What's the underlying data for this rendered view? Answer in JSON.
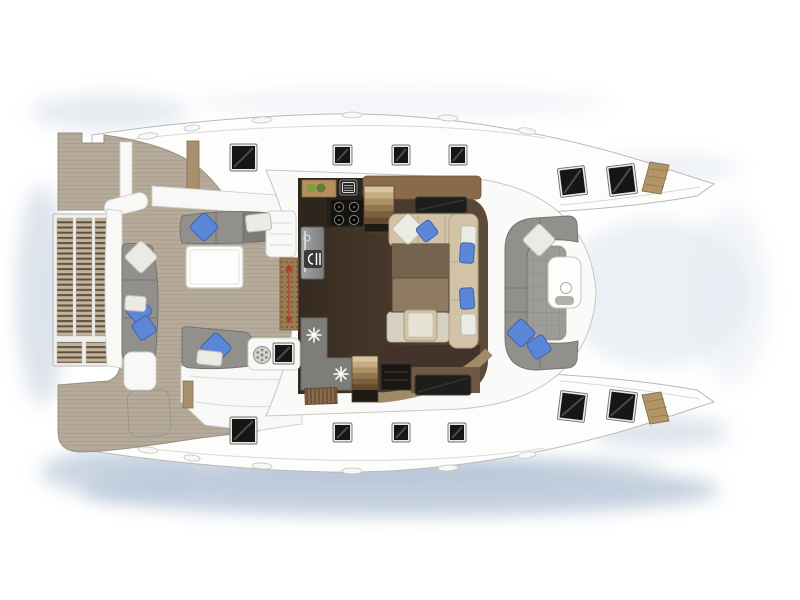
{
  "meta": {
    "title": "Catamaran yacht deck and saloon floor plan, top view",
    "type": "boat-floor-plan",
    "canvas": {
      "width": 800,
      "height": 600
    },
    "text_visible": "none"
  },
  "palette": {
    "bg": "#ffffff",
    "hull_white": "#fdfdfc",
    "hull_outline": "#b9b9b6",
    "deck_seam": "#d8d8d5",
    "cabin_white": "#fafaf8",
    "cabin_outline": "#c6c6c3",
    "teak": "#b6ab9a",
    "teak_line": "#8f8170",
    "teak_outline": "#97907f",
    "slat_tan": "#c3b39a",
    "slat_dark": "#5d5040",
    "platform_frame": "#f0efec",
    "platform_outline": "#b8b8b5",
    "post_tan": "#a9906c",
    "post_outline": "#86704f",
    "salon_floor_dark": "#352a20",
    "salon_floor_mid": "#5d4a38",
    "counter_dark": "#2e261d",
    "stove_black": "#141310",
    "burner_ring": "#75756f",
    "fridge_light": "#a3a4a6",
    "fridge_dark": "#7d7e80",
    "fridge_outline": "#5f5f5f",
    "counter_gray": "#7d7d79",
    "counter_gray_line": "#6a6a66",
    "wood_cabinet": "#8a6b49",
    "wood_dark": "#43332a",
    "wood_mid": "#6f5942",
    "wood_trim": "#a08a68",
    "stair_void": "#1f1a14",
    "bench_beige": "#d2c2a6",
    "bench_beige_line": "#b3a184",
    "bench_pale": "#d6d0c2",
    "table_wood_top": "#74634e",
    "table_wood_bottom": "#8f7b62",
    "table_wood_outline": "#4f4335",
    "ottoman_top": "#e7e2d6",
    "sofa_gray": "#91908c",
    "sofa_gray_dark": "#7e7c78",
    "sofa_line": "#75736f",
    "pillow_blue": "#5c86d8",
    "pillow_blue_edge": "#3e63a8",
    "pillow_white": "#ecebe3",
    "pillow_white_edge": "#bfbcb0",
    "hatch_frame": "#ececea",
    "hatch_frame_edge": "#6f6f6c",
    "hatch_glass": "#161614",
    "hatch_streak": "#8a8a86",
    "skylight": "#1d1d1b",
    "skylight_edge": "#3c3c38",
    "bow_step_tan": "#b29569",
    "bow_step_line": "#8a7048",
    "mat_brown": "#9b7b51",
    "mat_dot": "#6a4f30",
    "mat_outline": "#7c5f3c",
    "arrow_red": "#b5392e",
    "tile_gray": "#9c9c99",
    "tile_line": "#8b8b88",
    "white_furniture": "#f8f8f6",
    "white_furniture_outline": "#cfcfcc",
    "table_white": "#fdfdfc",
    "table_white_outline": "#c6c6c3",
    "green_decor": "#7da03f",
    "green_decor_dark": "#5e7f2c",
    "board_tan": "#b5905e",
    "board_outline": "#8a6b42",
    "shadow_blue": "#b4c3d6"
  },
  "elements": {
    "shadows": [
      {
        "cx": 400,
        "cy": 490,
        "rx": 320,
        "ry": 26,
        "color": "#b4c3d6",
        "opacity": 0.8
      },
      {
        "cx": 360,
        "cy": 468,
        "rx": 300,
        "ry": 11,
        "color": "#9db0c8",
        "opacity": 0.5
      },
      {
        "cx": 120,
        "cy": 472,
        "rx": 80,
        "ry": 22,
        "color": "#bcc9da",
        "opacity": 0.7
      },
      {
        "cx": 660,
        "cy": 432,
        "rx": 70,
        "ry": 16,
        "color": "#c8d3e1",
        "opacity": 0.6
      },
      {
        "cx": 42,
        "cy": 295,
        "rx": 26,
        "ry": 110,
        "color": "#c8d2e0",
        "opacity": 0.6
      },
      {
        "cx": 110,
        "cy": 112,
        "rx": 80,
        "ry": 18,
        "color": "#d6dee8",
        "opacity": 0.6
      },
      {
        "cx": 400,
        "cy": 103,
        "rx": 210,
        "ry": 14,
        "color": "#e4e9f0",
        "opacity": 0.5
      },
      {
        "cx": 665,
        "cy": 168,
        "rx": 75,
        "ry": 14,
        "color": "#dbe2ec",
        "opacity": 0.5
      },
      {
        "cx": 655,
        "cy": 293,
        "rx": 95,
        "ry": 75,
        "color": "#dde4ed",
        "opacity": 0.55
      },
      {
        "cx": 730,
        "cy": 295,
        "rx": 40,
        "ry": 90,
        "color": "#e6ebf2",
        "opacity": 0.5
      }
    ],
    "deck_hatches": [
      {
        "x": 232,
        "y": 146,
        "w": 23,
        "h": 23,
        "rot": 0
      },
      {
        "x": 335,
        "y": 147,
        "w": 15,
        "h": 16,
        "rot": 0
      },
      {
        "x": 394,
        "y": 147,
        "w": 14,
        "h": 16,
        "rot": 0
      },
      {
        "x": 451,
        "y": 147,
        "w": 14,
        "h": 16,
        "rot": 0
      },
      {
        "x": 561,
        "y": 169,
        "w": 23,
        "h": 25,
        "rot": -7
      },
      {
        "x": 610,
        "y": 167,
        "w": 24,
        "h": 26,
        "rot": -7
      },
      {
        "x": 232,
        "y": 419,
        "w": 23,
        "h": 23,
        "rot": 0
      },
      {
        "x": 335,
        "y": 425,
        "w": 15,
        "h": 15,
        "rot": 0
      },
      {
        "x": 394,
        "y": 425,
        "w": 14,
        "h": 15,
        "rot": 0
      },
      {
        "x": 450,
        "y": 425,
        "w": 14,
        "h": 15,
        "rot": 0
      },
      {
        "x": 561,
        "y": 394,
        "w": 23,
        "h": 25,
        "rot": 7
      },
      {
        "x": 610,
        "y": 393,
        "w": 24,
        "h": 26,
        "rot": 7
      },
      {
        "x": 275,
        "y": 345,
        "w": 17,
        "h": 17,
        "rot": 0
      }
    ],
    "skylights": [
      {
        "x": 415,
        "y": 197,
        "w": 52,
        "h": 16
      },
      {
        "x": 415,
        "y": 375,
        "w": 56,
        "h": 20
      }
    ],
    "pillows": [
      {
        "shape": "diamond",
        "color": "blue",
        "cx": 204,
        "cy": 227,
        "size": 21,
        "rot": 0
      },
      {
        "shape": "diamond",
        "color": "white",
        "cx": 141,
        "cy": 257,
        "size": 24,
        "rot": 0
      },
      {
        "shape": "diamond",
        "color": "blue",
        "cx": 139,
        "cy": 311,
        "size": 20,
        "rot": 0
      },
      {
        "shape": "diamond",
        "color": "blue",
        "cx": 144,
        "cy": 328,
        "size": 19,
        "rot": 10
      },
      {
        "shape": "diamond",
        "color": "blue",
        "cx": 216,
        "cy": 348,
        "size": 23,
        "rot": 0
      },
      {
        "shape": "diamond",
        "color": "white",
        "cx": 408,
        "cy": 229,
        "size": 23,
        "rot": 0
      },
      {
        "shape": "diamond",
        "color": "blue",
        "cx": 427,
        "cy": 231,
        "size": 17,
        "rot": 8
      },
      {
        "shape": "diamond",
        "color": "white",
        "cx": 539,
        "cy": 240,
        "size": 24,
        "rot": 0
      },
      {
        "shape": "diamond",
        "color": "blue",
        "cx": 521,
        "cy": 333,
        "size": 21,
        "rot": 0
      },
      {
        "shape": "diamond",
        "color": "blue",
        "cx": 539,
        "cy": 347,
        "size": 19,
        "rot": 12
      },
      {
        "shape": "rect",
        "color": "white",
        "x": 246,
        "y": 214,
        "w": 25,
        "h": 17,
        "rot": -6
      },
      {
        "shape": "rect",
        "color": "white",
        "x": 125,
        "y": 296,
        "w": 21,
        "h": 15,
        "rot": 4
      },
      {
        "shape": "rect",
        "color": "white",
        "x": 197,
        "y": 351,
        "w": 25,
        "h": 14,
        "rot": 6
      },
      {
        "shape": "rect",
        "color": "white",
        "x": 461,
        "y": 226,
        "w": 15,
        "h": 22,
        "rot": 2
      },
      {
        "shape": "rect",
        "color": "blue",
        "x": 460,
        "y": 243,
        "w": 14,
        "h": 20,
        "rot": 4
      },
      {
        "shape": "rect",
        "color": "blue",
        "x": 460,
        "y": 288,
        "w": 14,
        "h": 21,
        "rot": -4
      },
      {
        "shape": "rect",
        "color": "white",
        "x": 461,
        "y": 314,
        "w": 15,
        "h": 21,
        "rot": -2
      }
    ],
    "bow_steps": [
      {
        "points": "642,191 650,162 669,165 661,194",
        "lines": [
          [
            645,
            184,
            664,
            187
          ],
          [
            648,
            176,
            667,
            179
          ],
          [
            651,
            169,
            669,
            171
          ]
        ]
      },
      {
        "points": "642,395 650,424 669,421 661,392",
        "lines": [
          [
            645,
            402,
            664,
            399
          ],
          [
            648,
            410,
            667,
            407
          ],
          [
            651,
            417,
            669,
            415
          ]
        ]
      }
    ],
    "deck_fittings": [
      {
        "cx": 148,
        "cy": 136,
        "rx": 10,
        "ry": 3,
        "rot": -6
      },
      {
        "cx": 192,
        "cy": 128,
        "rx": 8,
        "ry": 3,
        "rot": -6
      },
      {
        "cx": 262,
        "cy": 120,
        "rx": 10,
        "ry": 3,
        "rot": -3
      },
      {
        "cx": 352,
        "cy": 115,
        "rx": 10,
        "ry": 3,
        "rot": 0
      },
      {
        "cx": 448,
        "cy": 118,
        "rx": 10,
        "ry": 3,
        "rot": 3
      },
      {
        "cx": 527,
        "cy": 131,
        "rx": 9,
        "ry": 3,
        "rot": 8
      },
      {
        "cx": 148,
        "cy": 450,
        "rx": 10,
        "ry": 3,
        "rot": 6
      },
      {
        "cx": 192,
        "cy": 458,
        "rx": 8,
        "ry": 3,
        "rot": 6
      },
      {
        "cx": 262,
        "cy": 466,
        "rx": 10,
        "ry": 3,
        "rot": 3
      },
      {
        "cx": 352,
        "cy": 471,
        "rx": 10,
        "ry": 3,
        "rot": 0
      },
      {
        "cx": 448,
        "cy": 468,
        "rx": 10,
        "ry": 3,
        "rot": -3
      },
      {
        "cx": 527,
        "cy": 455,
        "rx": 9,
        "ry": 3,
        "rot": -8
      }
    ],
    "snowflake_icons": [
      {
        "cx": 314,
        "cy": 335,
        "r": 7
      },
      {
        "cx": 341,
        "cy": 374,
        "r": 7
      }
    ],
    "stove_burners": [
      {
        "cx": 339,
        "cy": 207
      },
      {
        "cx": 354,
        "cy": 207
      },
      {
        "cx": 339,
        "cy": 220
      },
      {
        "cx": 354,
        "cy": 220
      }
    ],
    "stairs": [
      {
        "x": 364,
        "y": 186,
        "w": 30,
        "h": 38,
        "void_h": 8
      },
      {
        "x": 352,
        "y": 356,
        "w": 26,
        "h": 34,
        "void_h": 12
      }
    ],
    "tread_colors": [
      "#d8c49e",
      "#c4ab80",
      "#ac9165",
      "#93784f",
      "#7a613c",
      "#624c2d"
    ]
  },
  "icons": [
    {
      "name": "stove-burners-icon",
      "location": "galley cooktop"
    },
    {
      "name": "sink-icon",
      "location": "galley counter"
    },
    {
      "name": "cutting-board-icon",
      "location": "galley counter"
    },
    {
      "name": "cutlery-icon",
      "location": "galley refrigerator front"
    },
    {
      "name": "snowflake-fridge-icon",
      "location": "galley cold drawers",
      "count": 2
    },
    {
      "name": "wine-rack-icon",
      "location": "galley lower cabinet"
    },
    {
      "name": "round-grate-icon",
      "location": "aft cockpit module"
    },
    {
      "name": "direction-arrows-icon",
      "location": "saloon entry mat"
    }
  ],
  "rooms": [
    "aft-platform-grating",
    "starboard-quarter-deck",
    "port-quarter-deck",
    "aft-cockpit",
    "galley",
    "saloon-dining",
    "forward-cockpit",
    "starboard-hull-deck",
    "port-hull-deck",
    "bow-steps"
  ]
}
